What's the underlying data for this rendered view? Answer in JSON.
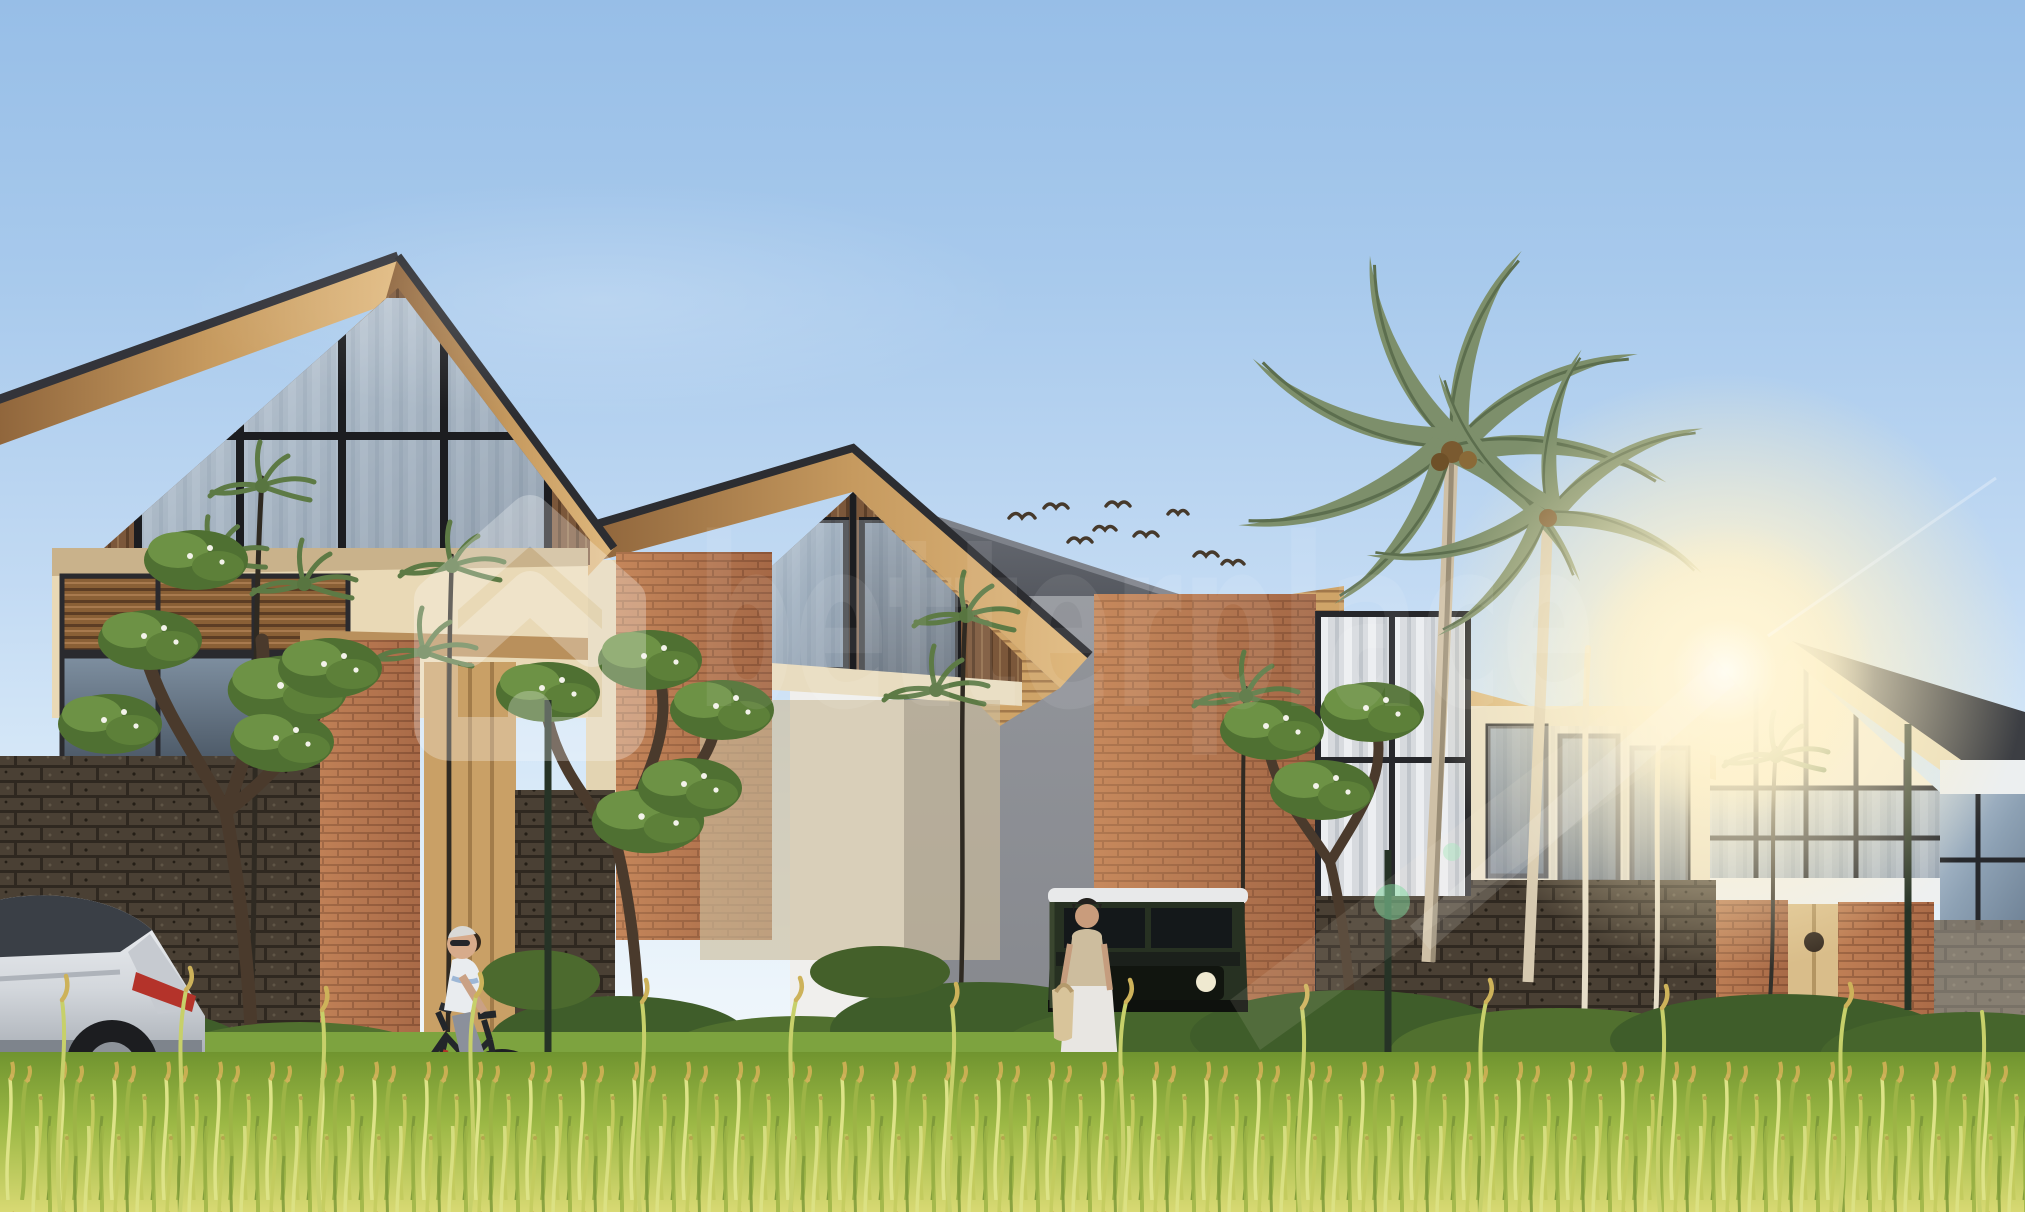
{
  "watermark": {
    "logo_icon": "betterplace-house-logo",
    "text": "betterplace",
    "color": "#ffffff",
    "opacity": 0.27
  },
  "scene": {
    "type": "architectural-exterior-rendering",
    "setting": "row of modern tropical gable villas behind a rice paddy field",
    "lighting": "daylight with warm sun flare on the right",
    "sky": {
      "top_color": "#97bee7",
      "horizon_color": "#f3f7fa"
    },
    "sun": {
      "position": "right of center between villas",
      "glow_color": "#fff6dd"
    },
    "buildings": [
      {
        "name": "villa-1-left",
        "features": "dark gable roof with wood fascia, wood-slat gable, black-framed glass wall, louver windows, brick entry pier, wooden door, lava-stone fence"
      },
      {
        "name": "villa-2",
        "features": "gable roof with deep wood soffit, glass gable, tall brick pier"
      },
      {
        "name": "villa-3-middle",
        "features": "grey mono-pitch roof, white and grey walls, wide sunlit brick pier, curtained windows"
      },
      {
        "name": "villa-4-right",
        "features": "cream gable with black window grid, dark shingle roof, twin brick piers, stone base, wooden door"
      }
    ],
    "vegetation": [
      "coconut-palm-pair",
      "plumeria-trees",
      "slender-fern-trees",
      "garden-hedge",
      "golden-rice-paddy-foreground"
    ],
    "vehicles": [
      {
        "name": "silver-suv",
        "detail": "rear view, red taillight"
      },
      {
        "name": "dark-green-4x4-jeep",
        "detail": "white roof, round headlights"
      }
    ],
    "people": [
      {
        "name": "elderly-man-cycling",
        "detail": "white hair, sunglasses, white-blue polo, shorts"
      },
      {
        "name": "woman-walking-with-tote-bag",
        "detail": "black cap, beige top, long white skirt"
      }
    ],
    "animals": [
      {
        "name": "bird-flock",
        "count": 9
      }
    ],
    "palette": {
      "roof_dark": "#3a3d42",
      "roof_grey": "#55585f",
      "wood_fascia": "#c9a26b",
      "wood_dark": "#6e4f36",
      "brick": "#b97752",
      "brick_lit": "#d39c6a",
      "stone_wall": "#463d31",
      "cream_wall": "#ecdcba",
      "white_wall": "#f0efed",
      "grey_wall": "#a0a2a7",
      "glass": "#9fb2c4",
      "palm_green": "#7d8f6b",
      "hedge_green": "#3f5d2a",
      "grass_green": "#a9bf4e",
      "rice_gold": "#c9b85e"
    }
  }
}
